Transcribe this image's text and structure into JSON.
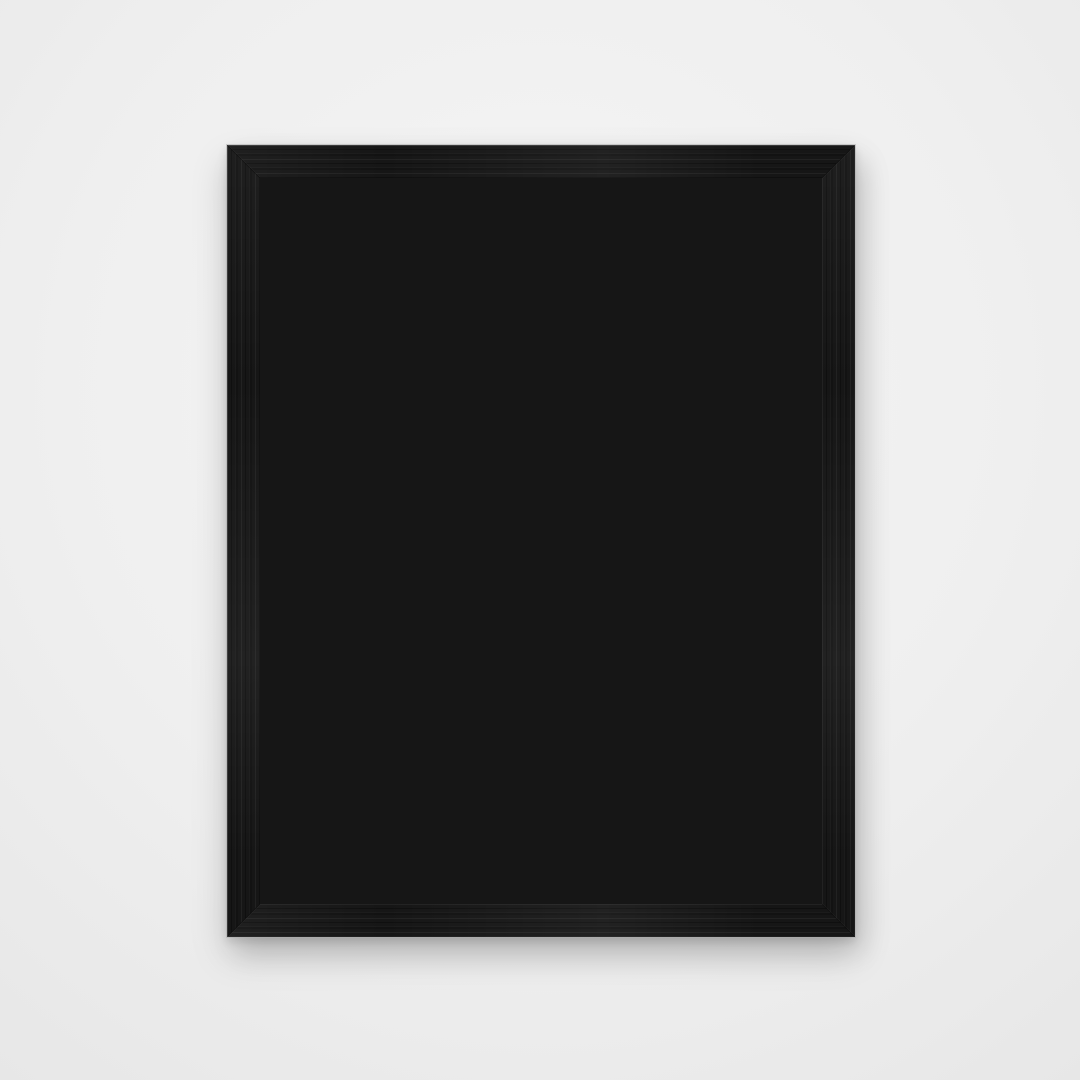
{
  "scene": {
    "description": "Back view of a black wood picture frame with a kraft paper backing board, metal sawtooth hangers and flexible retainer tabs, photographed on a light grey studio background",
    "orientation": "portrait",
    "subject": "picture frame back"
  },
  "colors": {
    "bg": "#efefef",
    "bg_center": "#f5f5f5",
    "bg_edge": "#e7e7e7",
    "frame": "#161616",
    "backing": "#b5976f",
    "metal_light": "#e9e9e9",
    "metal": "#c0c0c0",
    "metal_dark": "#8f8f8f",
    "hole": "#4e4030",
    "screw_slot": "#5c5c5c"
  },
  "hardware": {
    "sawtooth_hangers": [
      {
        "label": "sawtooth hanger - top center"
      },
      {
        "label": "sawtooth hanger - bottom center"
      },
      {
        "label": "sawtooth hanger - left middle"
      },
      {
        "label": "sawtooth hanger - right middle"
      }
    ],
    "flex_tabs": [
      {
        "label": "retainer tab - top left"
      },
      {
        "label": "retainer tab - top right"
      },
      {
        "label": "retainer tab - left upper"
      },
      {
        "label": "retainer tab - left lower"
      },
      {
        "label": "retainer tab - right upper"
      },
      {
        "label": "retainer tab - right lower"
      },
      {
        "label": "retainer tab - bottom left"
      },
      {
        "label": "retainer tab - bottom right"
      }
    ],
    "parts": {
      "frame_label": "black frame moulding",
      "backing_label": "kraft backing board"
    }
  }
}
